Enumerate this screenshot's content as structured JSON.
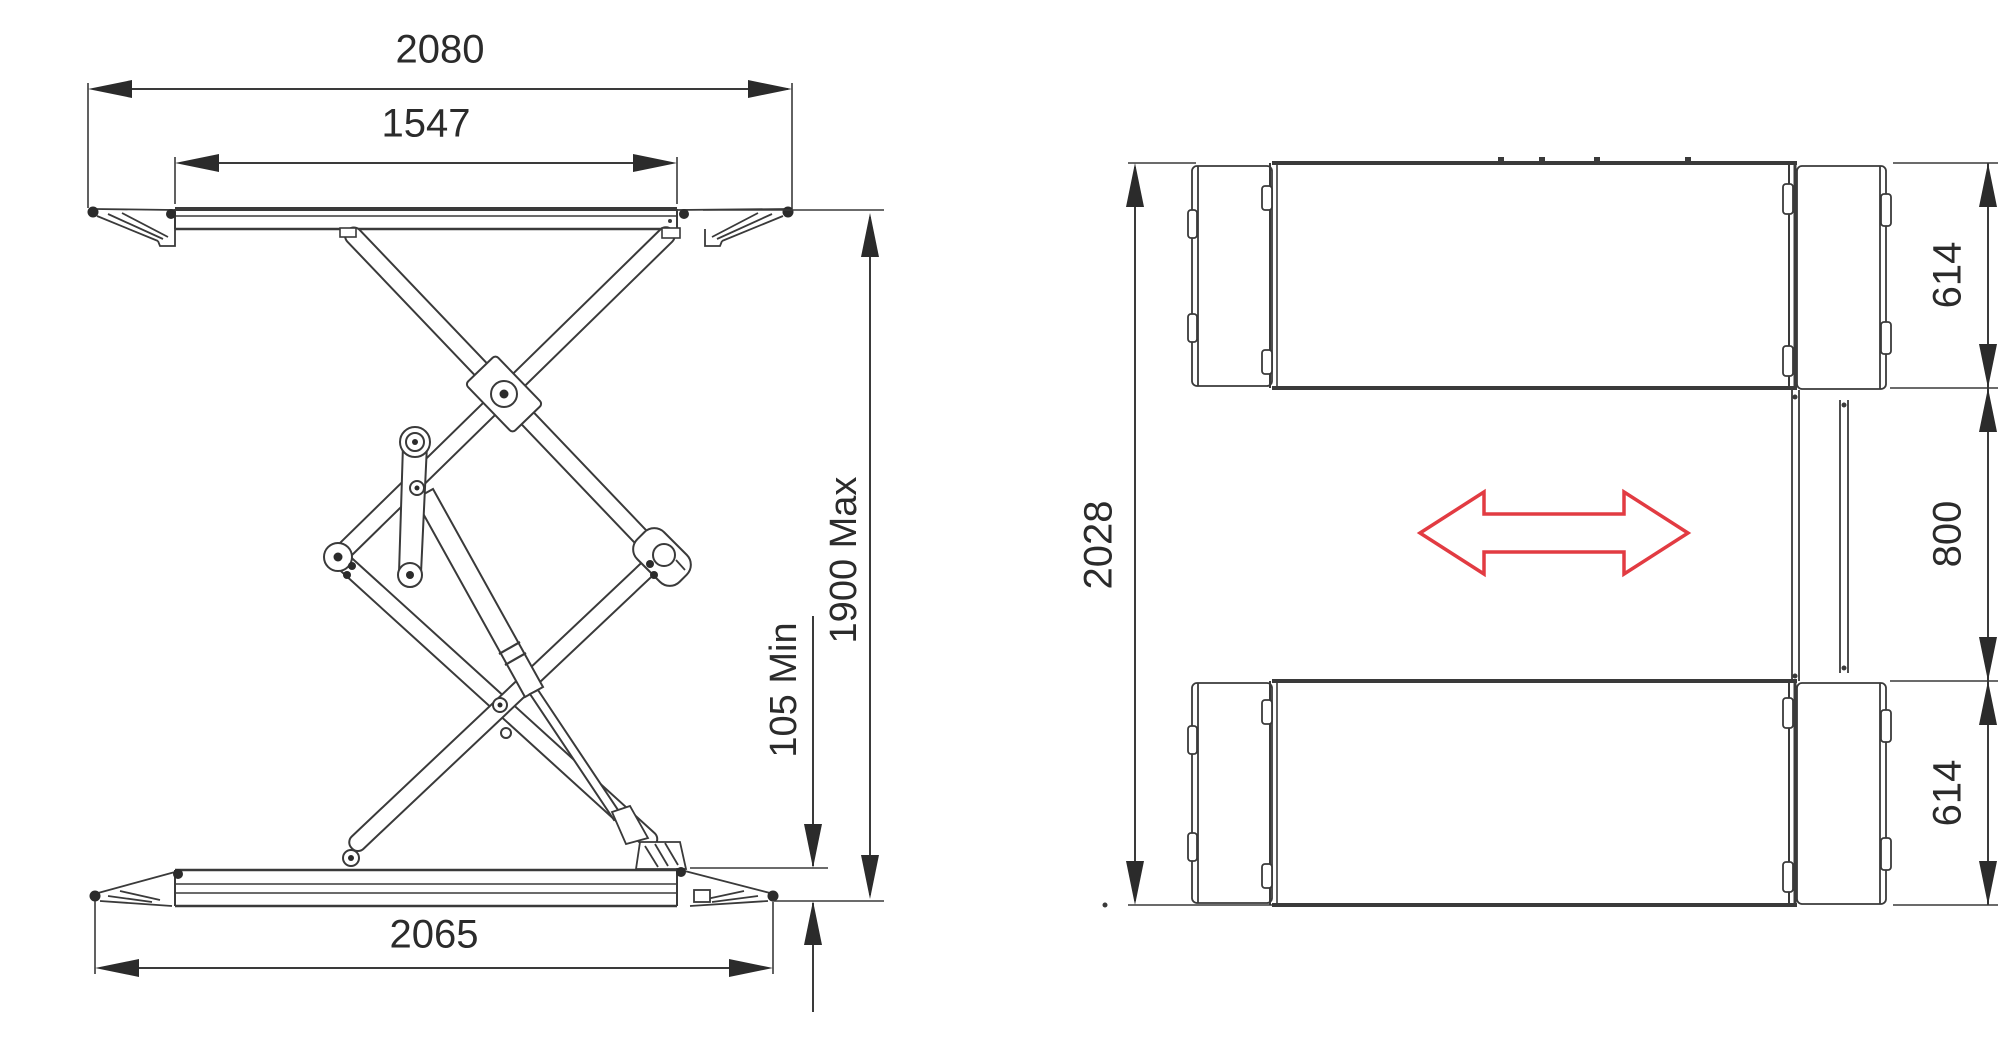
{
  "page": {
    "background": "#ffffff"
  },
  "drawing": {
    "type": "technical-drawing",
    "subject": "double scissor car lift - side elevation (left) and plan view (right)",
    "line_color": "#3a3a3a",
    "text_color": "#2b2b2b",
    "accent_arrow_color": "#e23b42"
  },
  "side_view": {
    "label": "side-elevation",
    "dims": {
      "top_width": "2080",
      "platform_length": "1547",
      "base_length": "2065",
      "min_height": "105 Min",
      "max_height": "1900 Max"
    }
  },
  "plan_view": {
    "label": "plan-view",
    "dims": {
      "overall_width": "2028",
      "platform_track_top": "614",
      "center_gap": "800",
      "platform_track_bottom": "614"
    }
  }
}
